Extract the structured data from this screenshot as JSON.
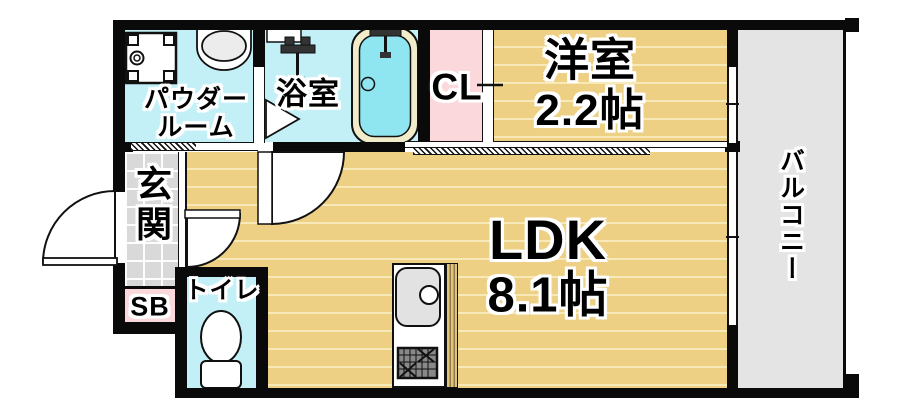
{
  "plan": {
    "type": "apartment-floor-plan",
    "rooms": {
      "powder_room": {
        "name_line1": "パウダー",
        "name_line2": "ルーム"
      },
      "bathroom": {
        "name": "浴室"
      },
      "closet": {
        "name": "CL"
      },
      "western_room": {
        "name": "洋室",
        "size": "2.2帖"
      },
      "balcony": {
        "name": "バルコニー"
      },
      "entrance": {
        "name": "玄関"
      },
      "shoe_box": {
        "name": "SB"
      },
      "toilet": {
        "name": "トイレ"
      },
      "ldk": {
        "name": "LDK",
        "size": "8.1帖"
      }
    },
    "colors": {
      "wet_area_cyan": "#c3f0f7",
      "closet_pink": "#fbd8dc",
      "wood_floor": "#edd084",
      "entrance_tile": "#d9d9d9",
      "balcony_gray": "#e4e4e4",
      "wall_black": "#0a0a0a",
      "bathtub_rim": "#f1ecca",
      "bathtub_water": "#8fe5f0"
    }
  }
}
